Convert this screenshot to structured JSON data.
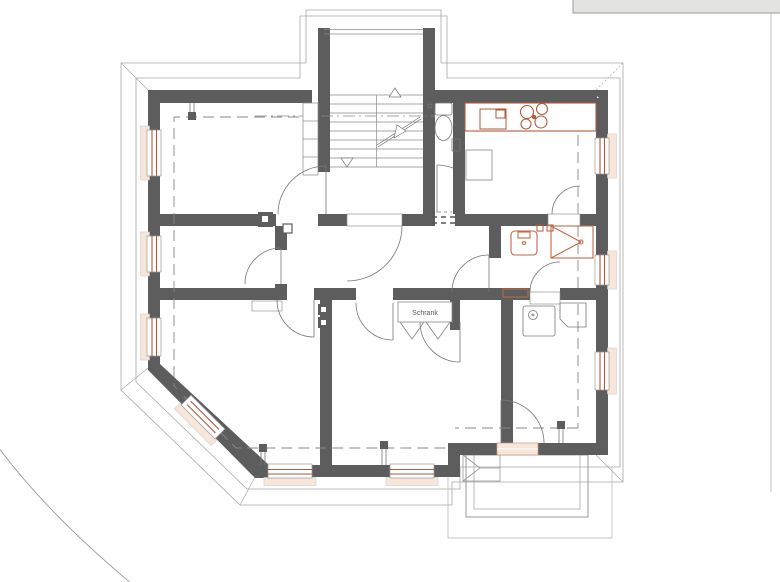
{
  "plan": {
    "labels": {
      "closet": "Schrank"
    },
    "colors": {
      "background": "#ffffff",
      "wall": "#5d5d5d",
      "window_frame": "#b2593b",
      "window_sill": "#f8e6da",
      "fixture_accent": "#bf6a45",
      "thin_line": "#777777",
      "eaves_outline": "#a8a8a8",
      "roof_dashed": "#888888",
      "neighbor_fill": "#e3e3e1"
    },
    "fixtures": [
      "staircase",
      "stair-direction-arrows",
      "built-in-shelf",
      "toilet",
      "kitchen-counter",
      "kitchen-sink",
      "cooktop",
      "kitchen-table",
      "washbasin",
      "shower",
      "wall-cabinet",
      "washing-machine",
      "desk",
      "closet-folding-doors",
      "balcony",
      "balcony-step",
      "chimney",
      "roof-posts",
      "windows",
      "door-swings",
      "site-boundary",
      "neighbor-building"
    ]
  }
}
